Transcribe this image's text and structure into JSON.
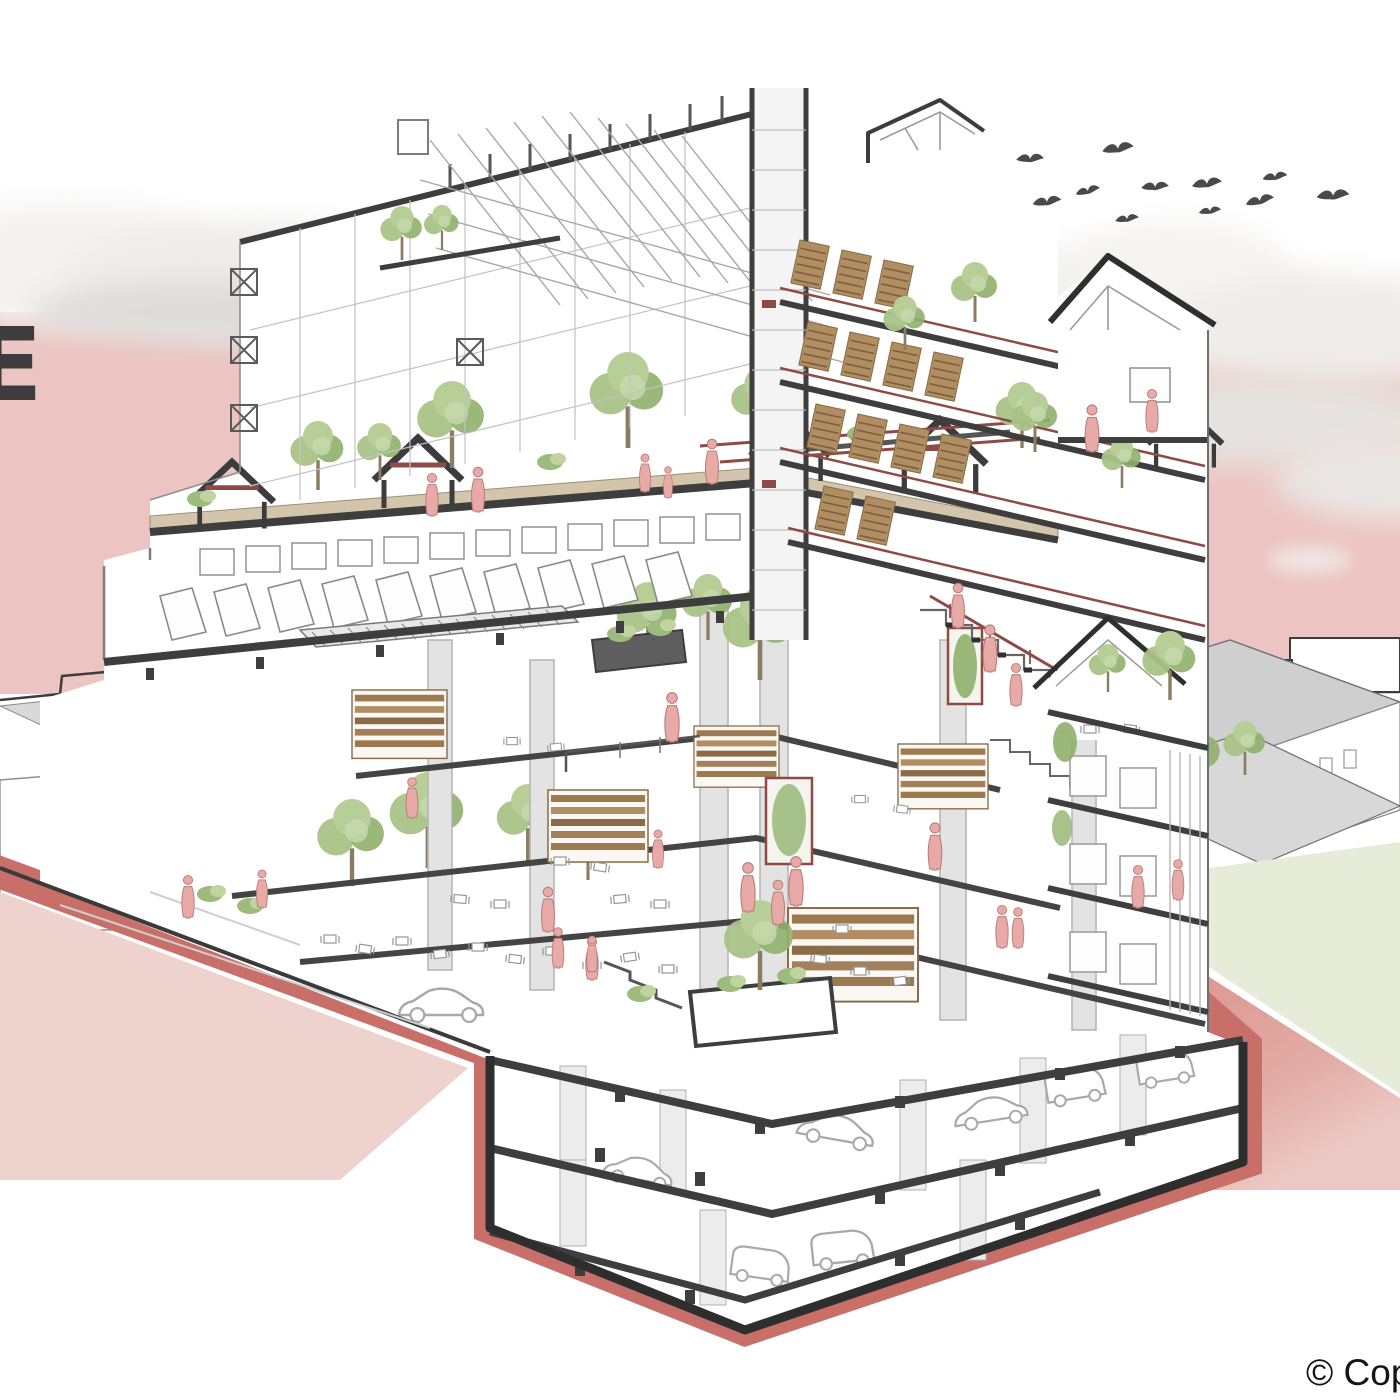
{
  "scene": {
    "description": "Sectional axonometric cutaway illustration of a terraced mixed-use building with rooftop gardens, library interior, cascading stairs and underground parking, set against a pink sky with clouds and a flock of birds; the excavated earth is shown as a red section cut.",
    "title_fragment": "E",
    "copyright_text": "© Copyri"
  },
  "palette": {
    "sky_pink": "#ecc4c1",
    "earth_light_pink": "#eed2ce",
    "earth_cut_red": "#c96f69",
    "earth_face_red": "#d6867f",
    "lawn_green": "#e7ecd8",
    "deck_tan": "#d2c5ab",
    "slab_dark": "#3e3e3e",
    "line_gray": "#8a8a8a",
    "wall_white": "#ffffff",
    "wall_gray": "#ececec",
    "people_pink": "#e7aaa7",
    "people_outline": "#b97c79",
    "railing_maroon": "#8e4b46",
    "shelf_brown": "#9c7a50",
    "foliage_green": "#a8c388",
    "foliage_dark": "#8fb06b",
    "foliage_light": "#c6d8ab",
    "bird_dark": "#4a4a4a",
    "roof_gray": "#cfcfcf",
    "cloud_white": "#f4f2f1",
    "text_black": "#141414"
  },
  "elements": {
    "birds_count": 14,
    "cloud_groups": 3,
    "people_count": 23,
    "cars_count": 8,
    "basement_levels": 3,
    "icons": {
      "bird": "bird-silhouette-glyph",
      "cloud": "blurred-ellipse-shape",
      "tree": "circle-cluster-with-trunk",
      "person": "pink-silhouette",
      "car": "outlined-car-shape",
      "pergola": "gable-frame"
    }
  }
}
